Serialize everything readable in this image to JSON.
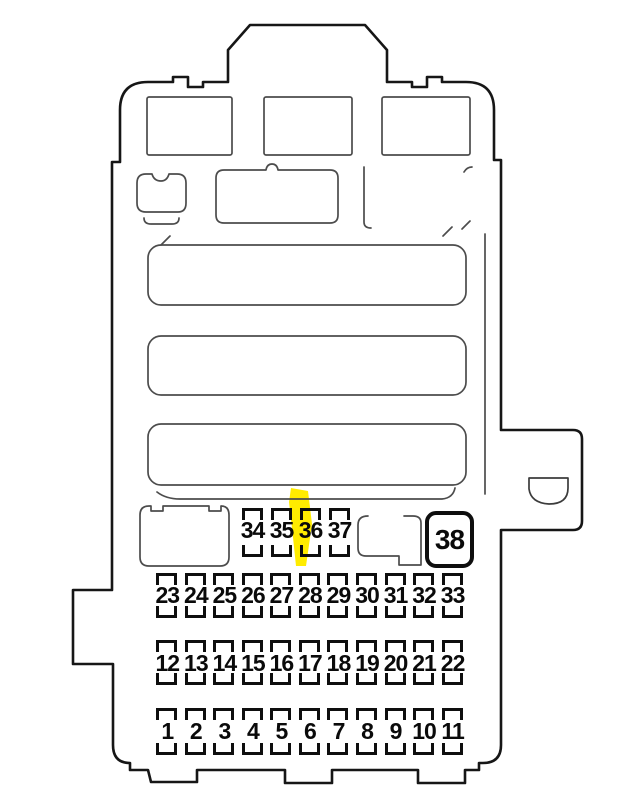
{
  "fuse_box": {
    "description_label": "interior fuse box diagram",
    "highlight": {
      "fuse": "36",
      "color": "#ffec00"
    },
    "rows": [
      {
        "id": "relay-row-34-37",
        "labels": [
          "34",
          "35",
          "36",
          "37"
        ]
      },
      {
        "id": "fuse-row-23-33",
        "labels": [
          "23",
          "24",
          "25",
          "26",
          "27",
          "28",
          "29",
          "30",
          "31",
          "32",
          "33"
        ]
      },
      {
        "id": "fuse-row-12-22",
        "labels": [
          "12",
          "13",
          "14",
          "15",
          "16",
          "17",
          "18",
          "19",
          "20",
          "21",
          "22"
        ]
      },
      {
        "id": "fuse-row-1-11",
        "labels": [
          "1",
          "2",
          "3",
          "4",
          "5",
          "6",
          "7",
          "8",
          "9",
          "10",
          "11"
        ]
      }
    ],
    "large_fuse": {
      "label": "38"
    },
    "colors": {
      "outline": "#161616",
      "detail": "#4c4c4c",
      "fuse_marks": "#0e0e0e",
      "background": "#ffffff",
      "highlight": "#ffec00"
    }
  }
}
